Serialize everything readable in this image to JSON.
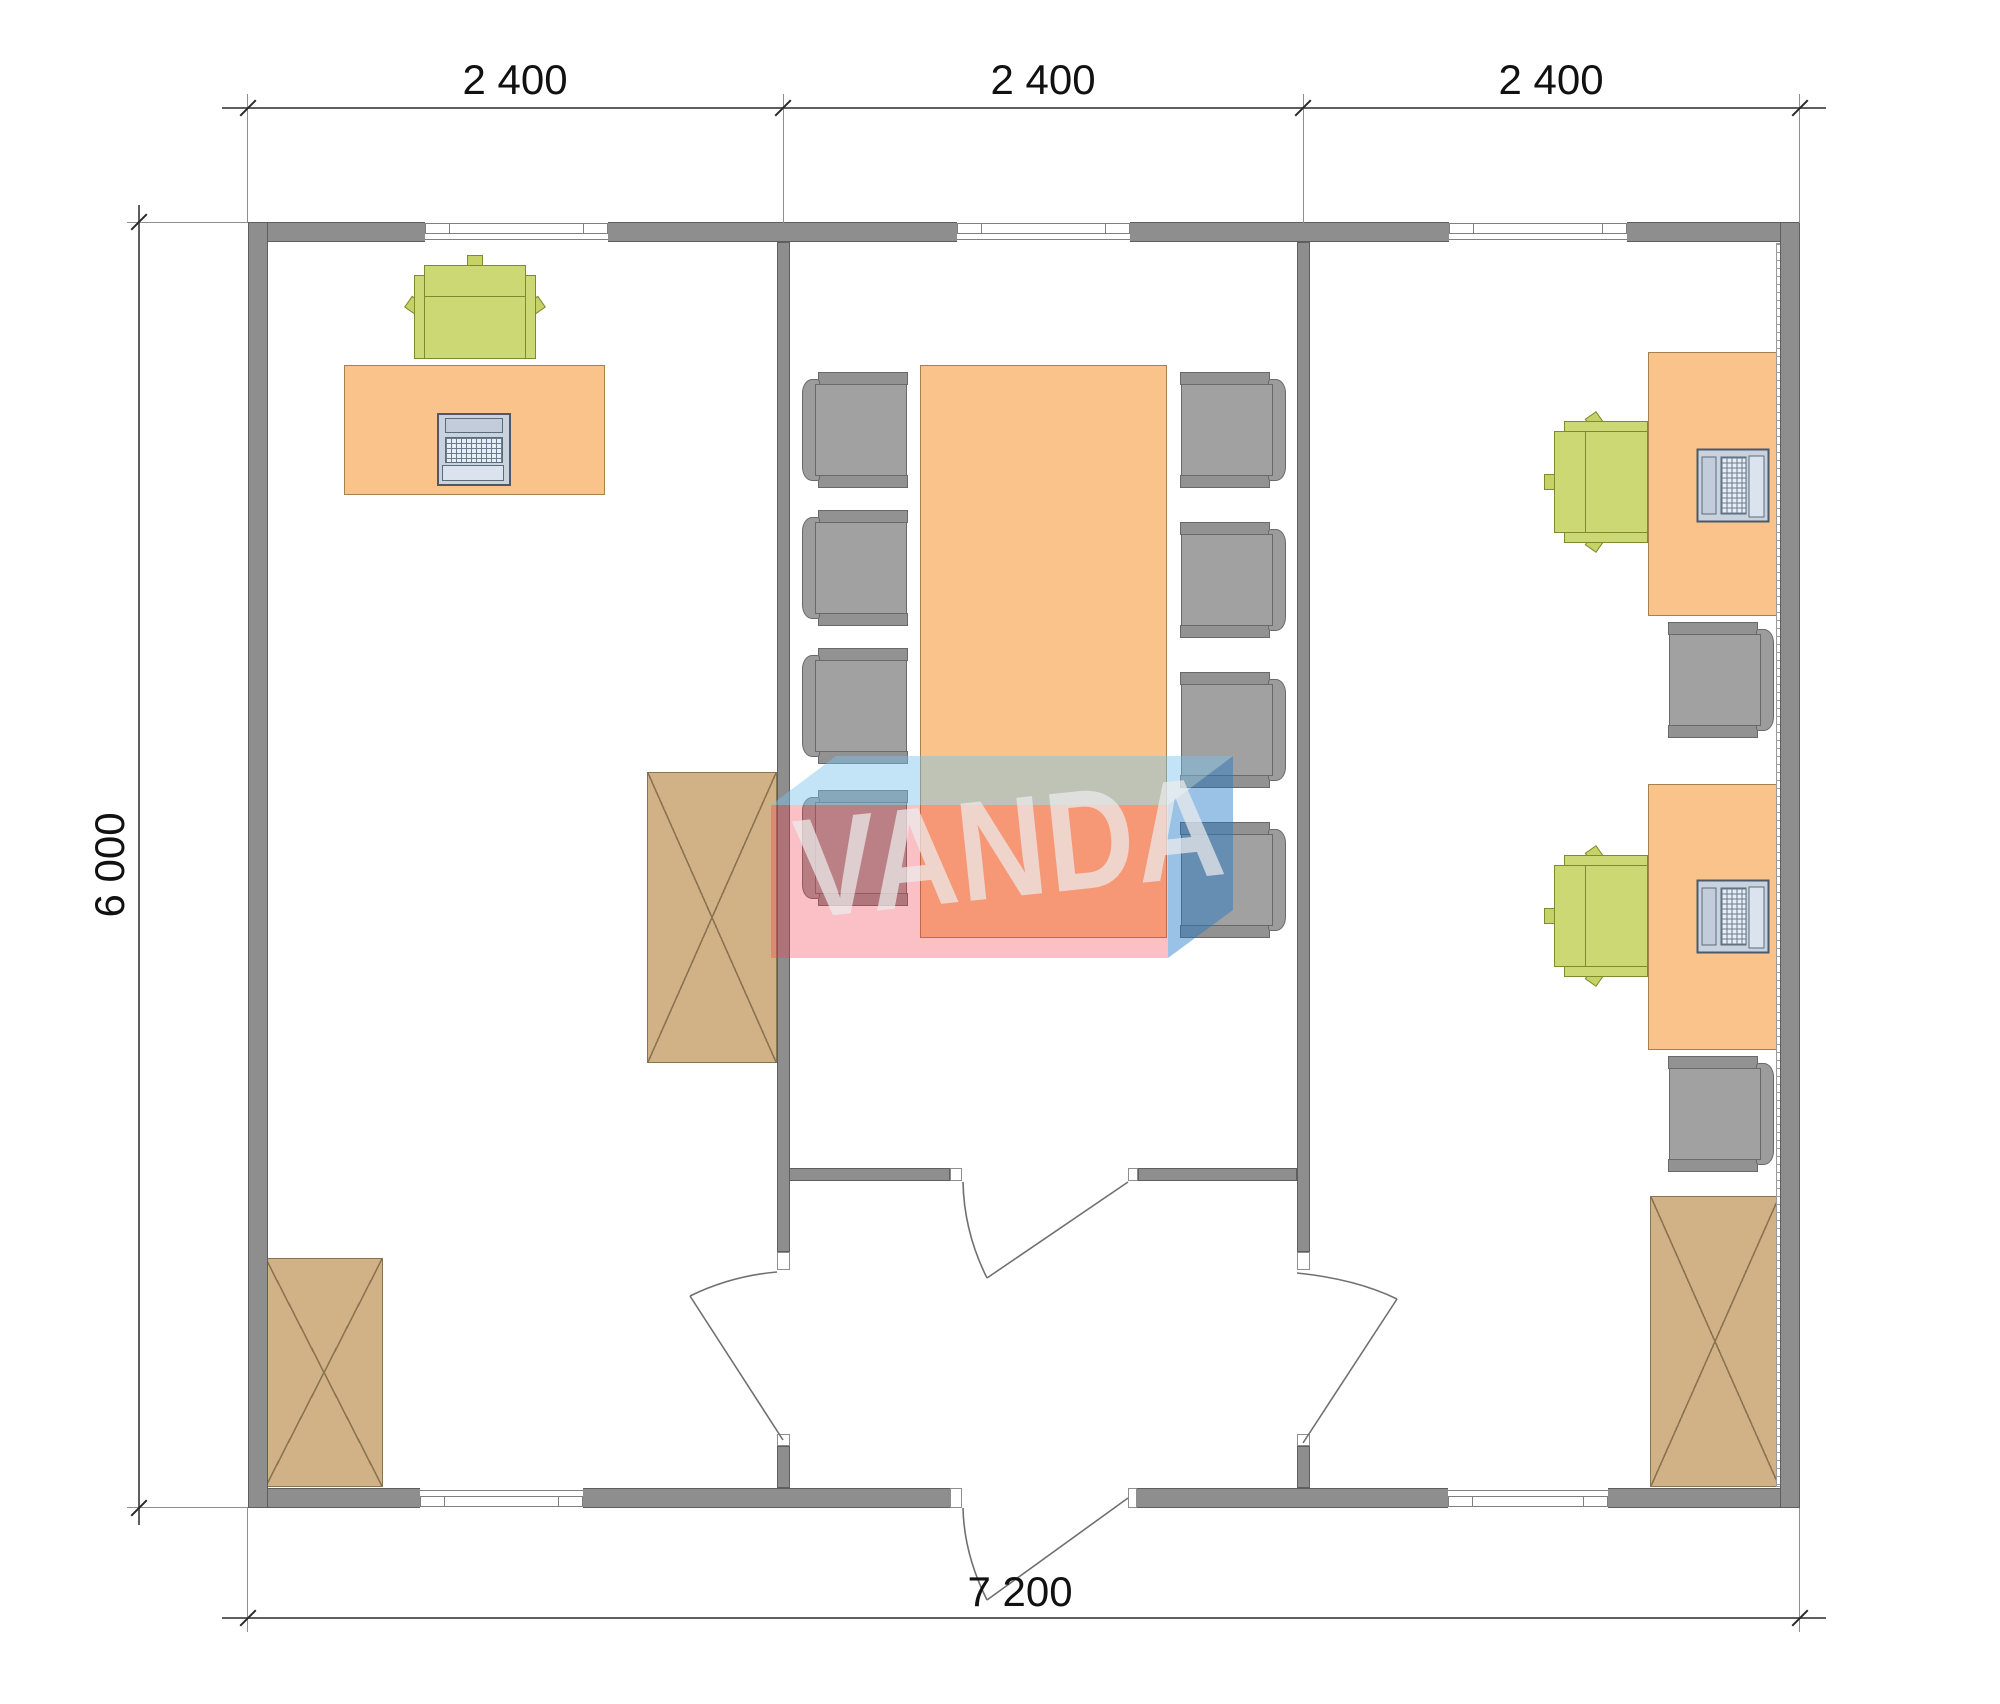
{
  "title": "Office floor plan 7200 x 6000",
  "dimensions": {
    "top": [
      "2 400",
      "2 400",
      "2 400"
    ],
    "left": "6 000",
    "bottom": "7 200"
  },
  "watermark": {
    "text": "VANDA",
    "red": "#ef3c4b",
    "blue": "#1e78c8",
    "light_blue": "#78c3eb"
  },
  "colors": {
    "wall": "#8e8e8e",
    "wall_edge": "#5e5e5e",
    "desk": "#f9c38b",
    "cabinet": "#d1b286",
    "chair_gray": "#9d9d9d",
    "chair_green": "#ccd873",
    "laptop": "#c9d3e0",
    "dimension_text": "#111111"
  },
  "inventory": {
    "left_room": {
      "desks": 1,
      "green_office_chairs": 1,
      "laptops": 1,
      "cabinets": 2
    },
    "middle_room": {
      "conference_tables": 1,
      "gray_chairs": 8
    },
    "right_room": {
      "desks": 2,
      "green_office_chairs": 2,
      "gray_chairs": 2,
      "laptops": 2,
      "cabinets": 1
    },
    "entrance_hall": {
      "doors": 4
    },
    "windows": 5
  }
}
